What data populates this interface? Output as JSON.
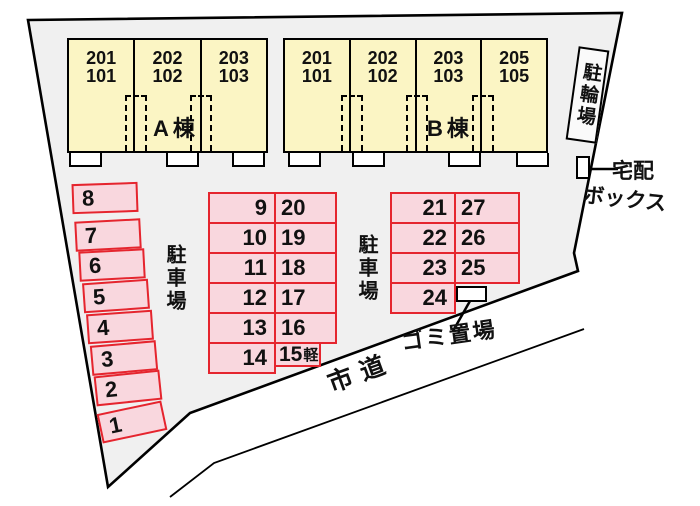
{
  "colors": {
    "site_fill": "#f0f0f0",
    "boundary": "#000000",
    "building_fill": "#fbf5c4",
    "building_border": "#000000",
    "parking_fill": "#f9d7de",
    "parking_border": "#e5252e",
    "text": "#111111"
  },
  "buildings": [
    {
      "name": "A棟",
      "units": [
        "201\n101",
        "202\n102",
        "203\n103"
      ]
    },
    {
      "name": "B棟",
      "units": [
        "201\n101",
        "202\n102",
        "203\n103",
        "205\n105"
      ]
    }
  ],
  "facilities": {
    "bicycle_parking": "駐輪場",
    "delivery_box": {
      "line1": "宅配",
      "line2": "ボックス"
    },
    "garbage_area": "ゴミ置場",
    "city_road": "市道",
    "parking_label_left": "駐車場",
    "parking_label_right": "駐車場"
  },
  "parking": {
    "left_column": [
      "8",
      "7",
      "6",
      "5",
      "4",
      "3",
      "2",
      "1"
    ],
    "middle_grid": {
      "left_cells": [
        "9",
        "10",
        "11",
        "12",
        "13",
        "14"
      ],
      "right_cells": [
        "20",
        "19",
        "18",
        "17",
        "16"
      ],
      "kei_cell": {
        "number": "15",
        "suffix": "軽"
      }
    },
    "right_grid": {
      "left_cells": [
        "21",
        "22",
        "23",
        "24"
      ],
      "right_cells": [
        "27",
        "26",
        "25"
      ]
    }
  }
}
